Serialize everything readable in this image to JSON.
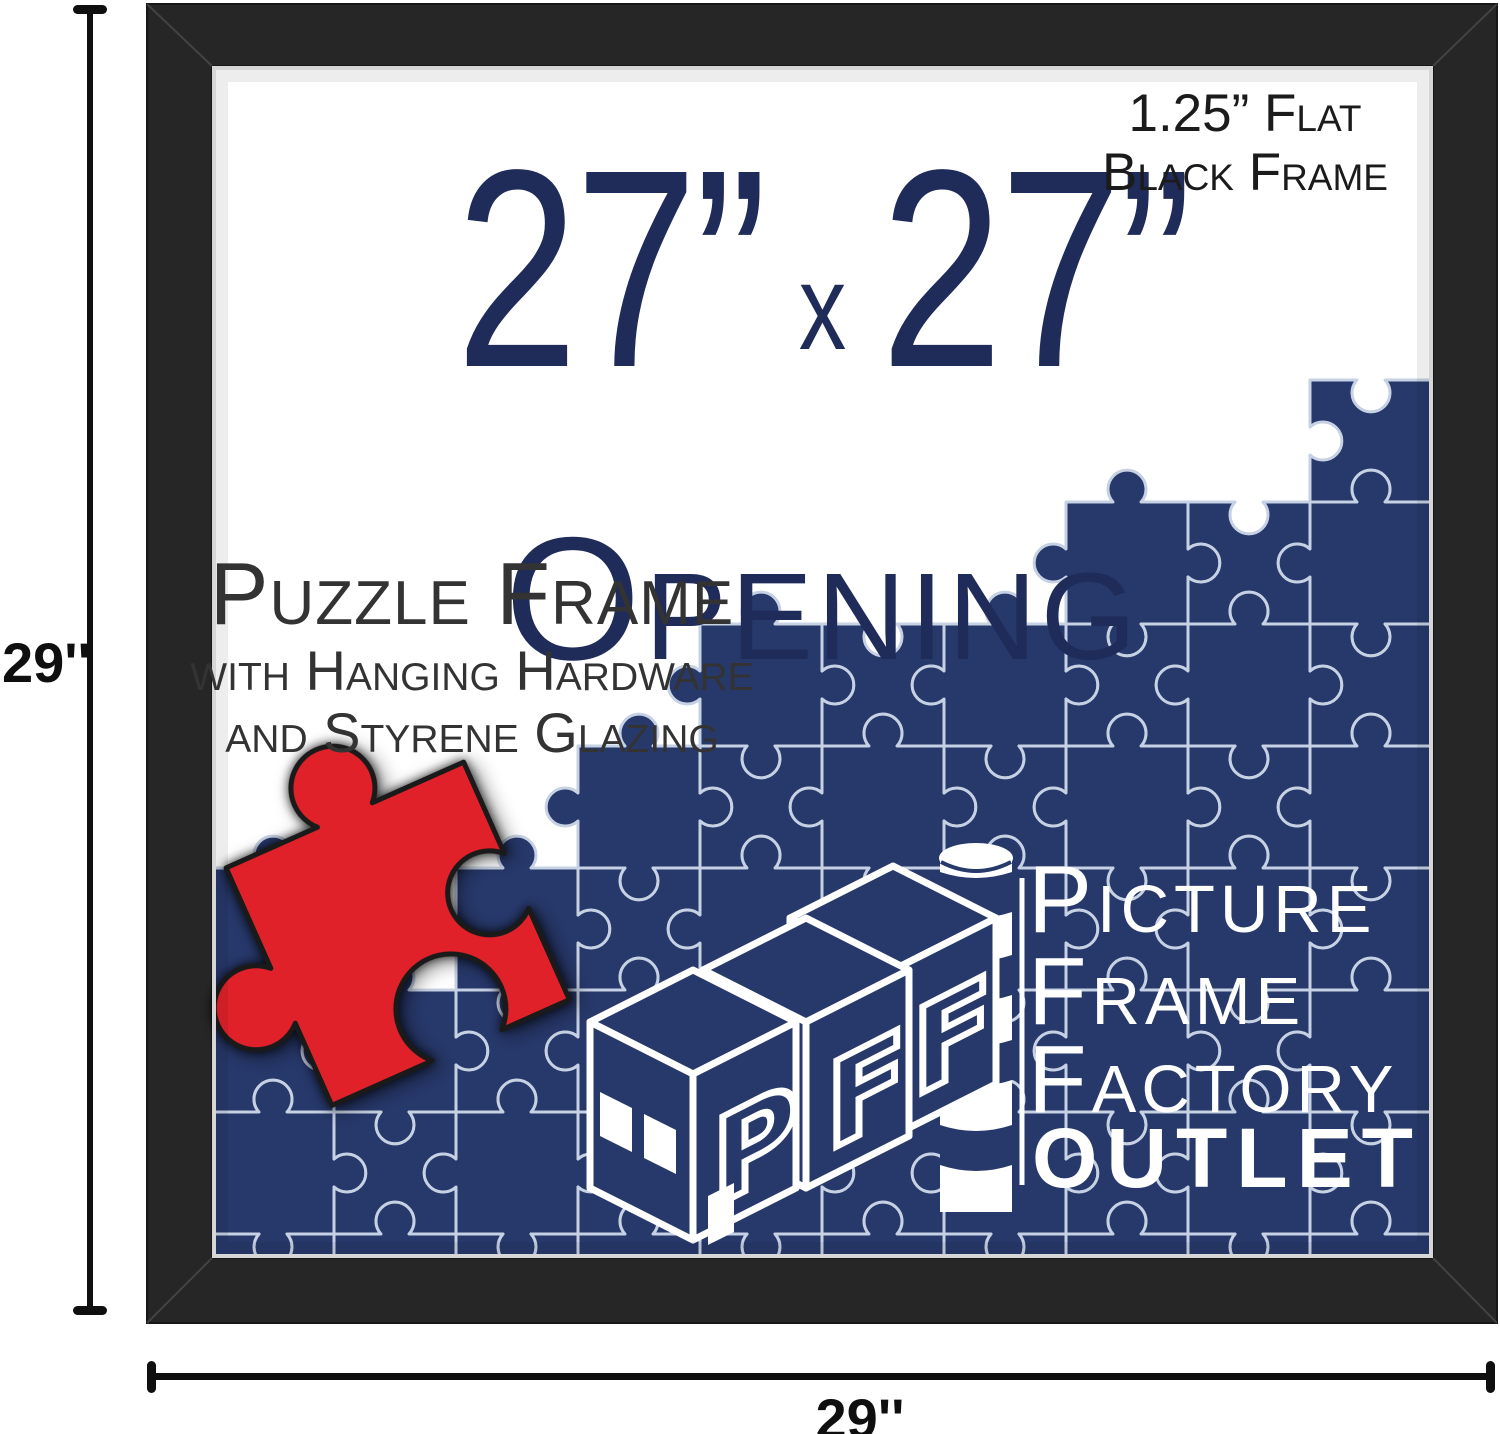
{
  "annotations": {
    "height_label": "29''",
    "width_label": "29''"
  },
  "frame_note": {
    "line1": "1.25” Flat",
    "line2": "Black Frame"
  },
  "opening_title": {
    "width": "27”",
    "separator": "x",
    "height": "27”",
    "caption": "Opening"
  },
  "product": {
    "line1": "Puzzle Frame",
    "line2": "with Hanging Hardware",
    "line3": "and Styrene Glazing"
  },
  "logo": {
    "letters": [
      "P",
      "F",
      "F"
    ],
    "line1": "Picture",
    "line2": "Frame",
    "line3": "Factory",
    "line4": "OUTLET"
  },
  "colors": {
    "navy": "#27386b",
    "puzzle_line": "#c6d1e3",
    "red": "#e0212a",
    "red_edge": "#1a1a1a",
    "frame_black": "#262626",
    "frame_seam": "#5a5a5a",
    "lip_gray": "#d6d6d6",
    "text_navy": "#1f2b59",
    "text_dark": "#1b1b1b",
    "text_gray": "#333333",
    "annotation_black": "#0f0f0f",
    "white": "#ffffff"
  },
  "artwork": {
    "puzzle": {
      "cell": 122,
      "origin_x": 212,
      "origin_y": 258,
      "knob_radius": 19,
      "knob_neck": 14,
      "columns": [
        [
          0,
          5,
          8
        ],
        [
          1,
          6,
          8
        ],
        [
          2,
          5,
          8
        ],
        [
          3,
          4,
          8
        ],
        [
          4,
          3,
          8
        ],
        [
          5,
          3,
          8
        ],
        [
          6,
          3,
          8
        ],
        [
          7,
          2,
          8
        ],
        [
          8,
          2,
          8
        ],
        [
          9,
          1,
          8
        ]
      ],
      "bounds": {
        "left": 214,
        "right": 1428,
        "top": 68,
        "bottom": 1254
      }
    }
  }
}
